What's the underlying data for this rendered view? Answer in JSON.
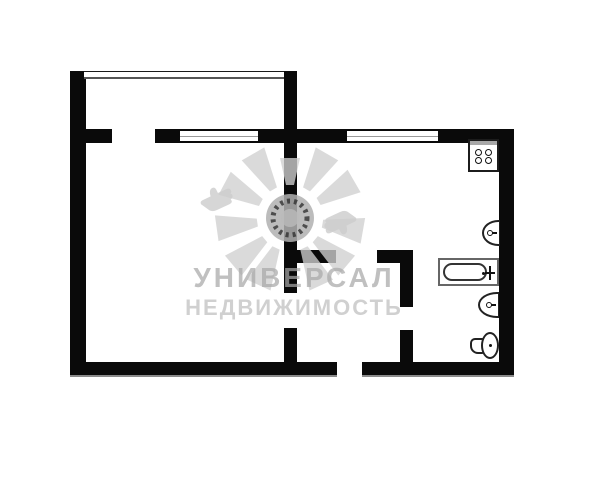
{
  "watermark": {
    "title": "УНИВЕРСАЛ",
    "subtitle": "НЕДВИЖИМОСТЬ",
    "logo": "sun-with-thumbs-up-logo"
  },
  "colors": {
    "wall": "#0a0a0a",
    "background": "#ffffff",
    "watermark_title": "#c4c4c4",
    "watermark_subtitle": "#d2d2d2",
    "fixture_outline": "#222222",
    "tub_outline": "#666666"
  },
  "floorplan": {
    "type": "apartment-floor-plan",
    "fixtures": [
      "stove",
      "kitchen-sink",
      "bathtub",
      "bathroom-sink",
      "toilet"
    ],
    "windows_count": 3,
    "door_openings_count": 5
  }
}
